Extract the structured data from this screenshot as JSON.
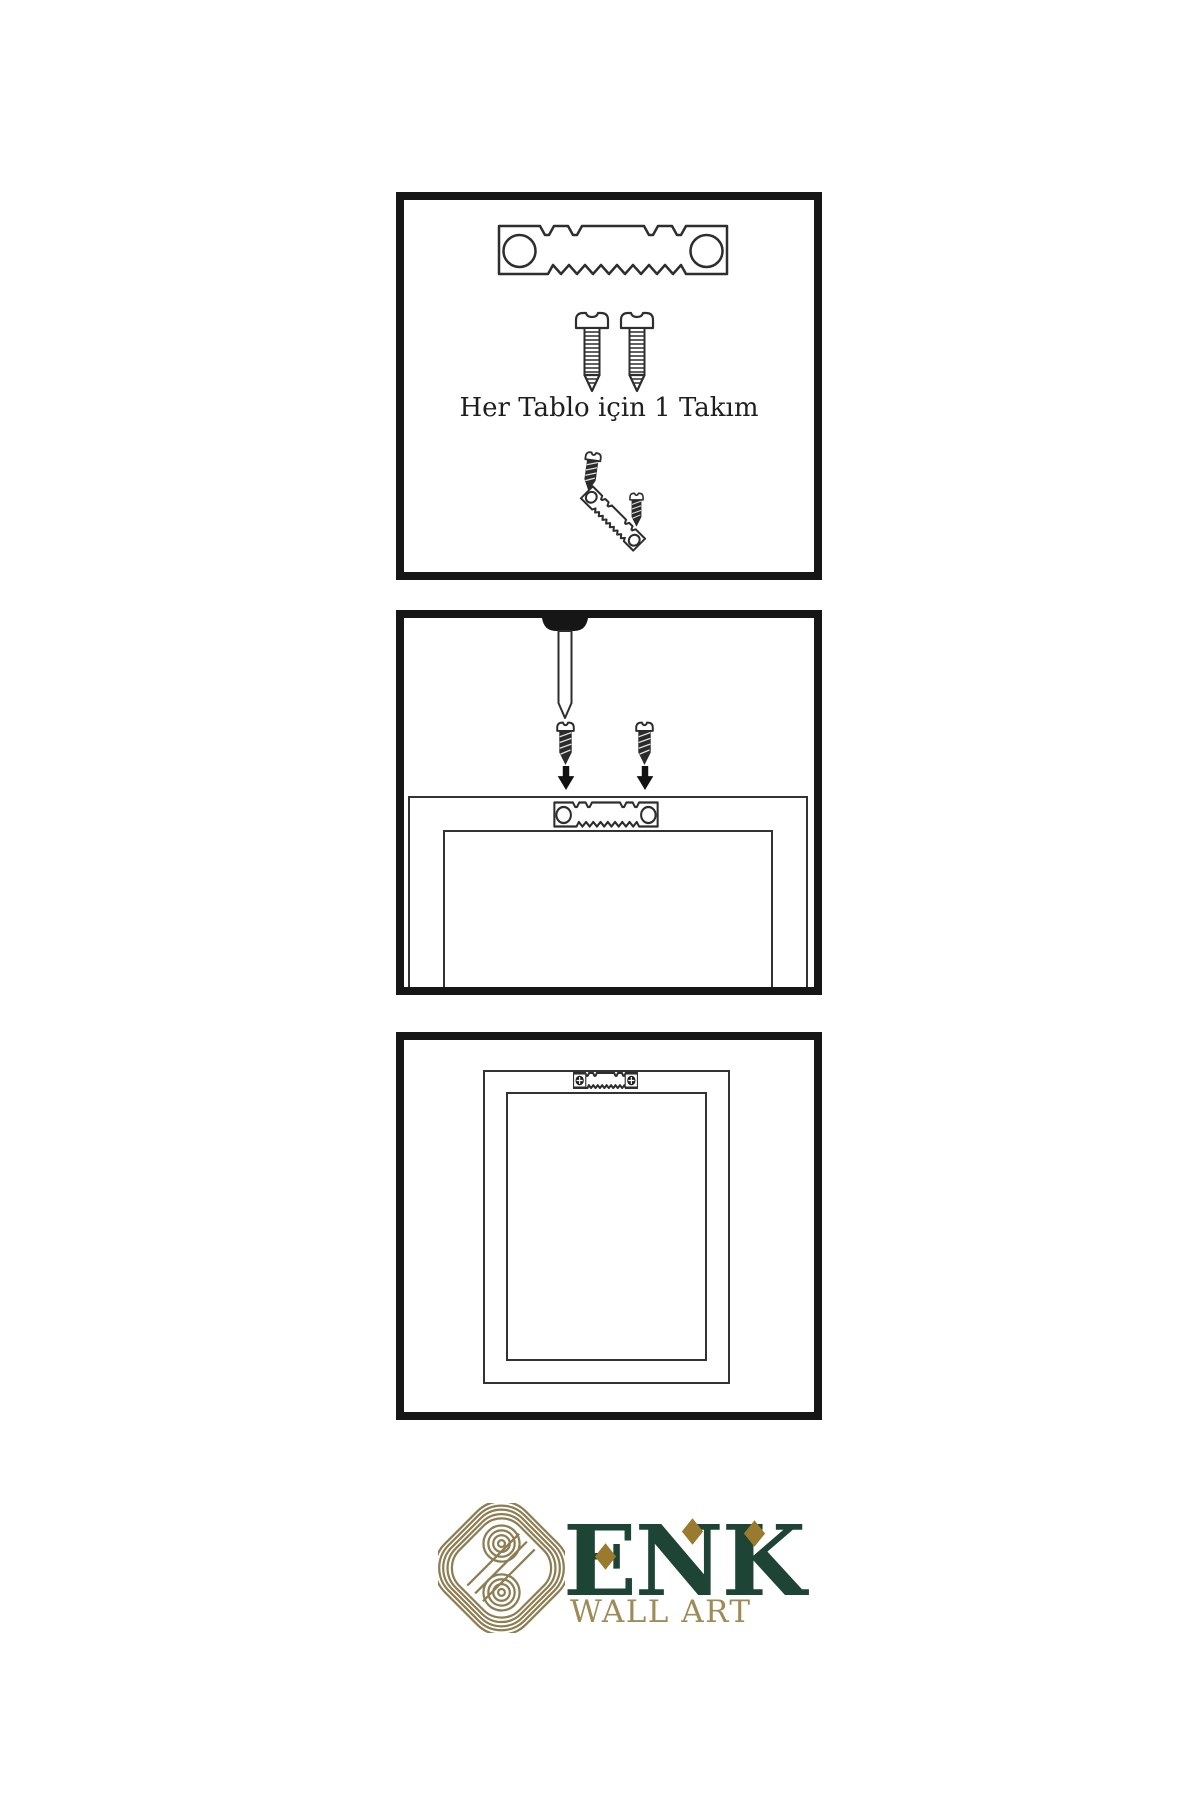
{
  "canvas": {
    "width": 1200,
    "height": 1800,
    "background": "#ffffff"
  },
  "colors": {
    "panel_border": "#161616",
    "diagram_outline": "#2e2e2e",
    "diagram_dark_fill": "#262626",
    "brand_green": "#1d4434",
    "accent_gold": "#9a7a2e",
    "knot_gold": "#8d7d52",
    "tagline_gold": "#9d8c57"
  },
  "steps": [
    {
      "id": "hardware-kit",
      "caption": "Her Tablo için 1 Takım",
      "icons": [
        "sawtooth-hanger",
        "mounting-screw",
        "mounting-screw",
        "screw-into-hanger-assembly"
      ]
    },
    {
      "id": "wall-mounting",
      "caption": "",
      "icons": [
        "wall-nail",
        "dark-screw",
        "dark-screw",
        "arrow-down",
        "arrow-down",
        "frame-back-with-sawtooth-hanger"
      ]
    },
    {
      "id": "hung-frame",
      "caption": "",
      "icons": [
        "frame-back-with-mounted-sawtooth-hanger"
      ]
    }
  ],
  "brand": {
    "name": "ENK",
    "tagline": "WALL ART",
    "logo": "interlaced-knot"
  }
}
